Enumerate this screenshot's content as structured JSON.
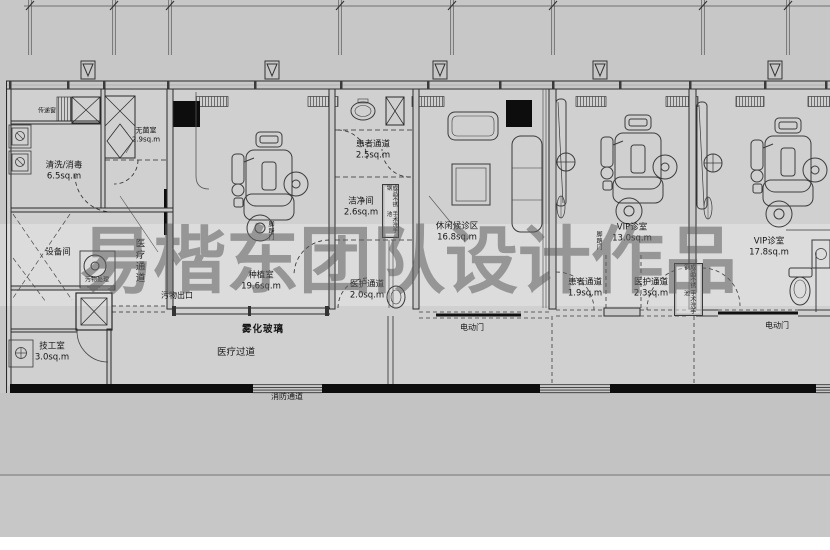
{
  "watermark": {
    "text": "易楷东团队设计作品"
  },
  "rooms": {
    "cleaning": {
      "name": "清洗/消毒",
      "area": "6.5sq.m"
    },
    "sterile": {
      "name": "无菌室",
      "area": "2.9sq.m"
    },
    "equipment": {
      "name": "设备间"
    },
    "tech": {
      "name": "技工室",
      "area": "3.0sq.m"
    },
    "implant": {
      "name": "种植室",
      "area": "19.6sq.m"
    },
    "patient_top": {
      "name": "患者通道",
      "area": "2.5sq.m"
    },
    "clean_room": {
      "name": "洁净间",
      "area": "2.6sq.m"
    },
    "staff_mid": {
      "name": "医护通道",
      "area": "2.0sq.m"
    },
    "lounge": {
      "name": "休闲候诊区",
      "area": "16.8sq.m"
    },
    "patient_vip": {
      "name": "患者通道",
      "area": "1.9sq.m"
    },
    "staff_vip": {
      "name": "医护通道",
      "area": "2.3sq.m"
    },
    "vip13": {
      "name": "VIP诊室",
      "area": "13.0sq.m"
    },
    "vip17": {
      "name": "VIP诊室",
      "area": "17.8sq.m"
    }
  },
  "annotations": {
    "pass_window": "传递窗",
    "waste_process": "污物处理",
    "medical_corridor": "医疗通道",
    "waste_exit": "污物出口",
    "fog_glass": "雾化玻璃",
    "medical_aisle": "医疗过道",
    "fire_passage": "消防通道",
    "electric_door": "电动门",
    "foot_pedal_door": "脚踏门",
    "steel_sink_col1": "成品不锈钢",
    "steel_sink_col2": "手术洗手池"
  }
}
